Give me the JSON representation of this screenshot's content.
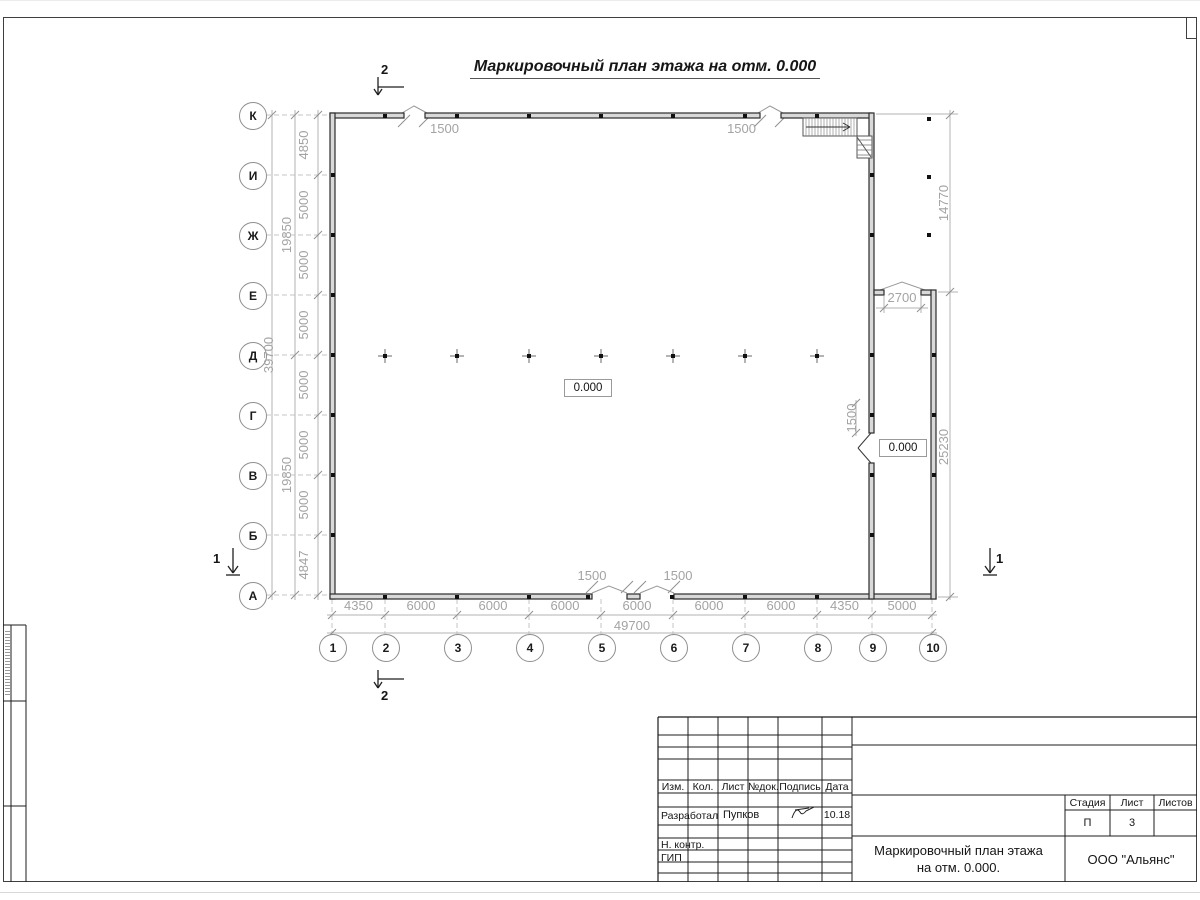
{
  "drawing": {
    "title": "Маркировочный план этажа на отм. 0.000",
    "row_axes": [
      "К",
      "И",
      "Ж",
      "Е",
      "Д",
      "Г",
      "В",
      "Б",
      "А"
    ],
    "col_axes": [
      "1",
      "2",
      "3",
      "4",
      "5",
      "6",
      "7",
      "8",
      "9",
      "10"
    ],
    "dims": {
      "left_segments": [
        "4850",
        "5000",
        "5000",
        "5000",
        "5000",
        "5000",
        "5000",
        "4847"
      ],
      "left_groups": [
        "19850",
        "19850"
      ],
      "left_total": "39700",
      "bottom_segments": [
        "4350",
        "6000",
        "6000",
        "6000",
        "6000",
        "6000",
        "6000",
        "4350",
        "5000"
      ],
      "bottom_total": "49700",
      "right_upper": "14770",
      "right_lower": "25230",
      "opening_top_1": "1500",
      "opening_top_2": "1500",
      "opening_bottom_1": "1500",
      "opening_bottom_2": "1500",
      "opening_right": "1500",
      "opening_annex": "2700"
    },
    "elevations": [
      "0.000",
      "0.000"
    ],
    "sections": {
      "top": "2",
      "bottom": "2",
      "left": "1",
      "right": "1"
    }
  },
  "title_block": {
    "col_headers": [
      "Изм.",
      "Кол.",
      "Лист",
      "№док.",
      "Подпись",
      "Дата"
    ],
    "developed_label": "Разработал",
    "developed_name": "Пупков",
    "developed_date": "10.18",
    "ncontrol_label": "Н. контр.",
    "gip_label": "ГИП",
    "stage_label": "Стадия",
    "sheet_label": "Лист",
    "sheets_label": "Листов",
    "stage_value": "П",
    "sheet_value": "3",
    "sheets_value": "",
    "doc_title_line1": "Маркировочный план этажа",
    "doc_title_line2": "на отм. 0.000.",
    "company": "ООО \"Альянс\""
  },
  "colors": {
    "wall": "#2c2c2c",
    "dim_line": "#b3b3b3",
    "frame": "#3f3f3f"
  }
}
